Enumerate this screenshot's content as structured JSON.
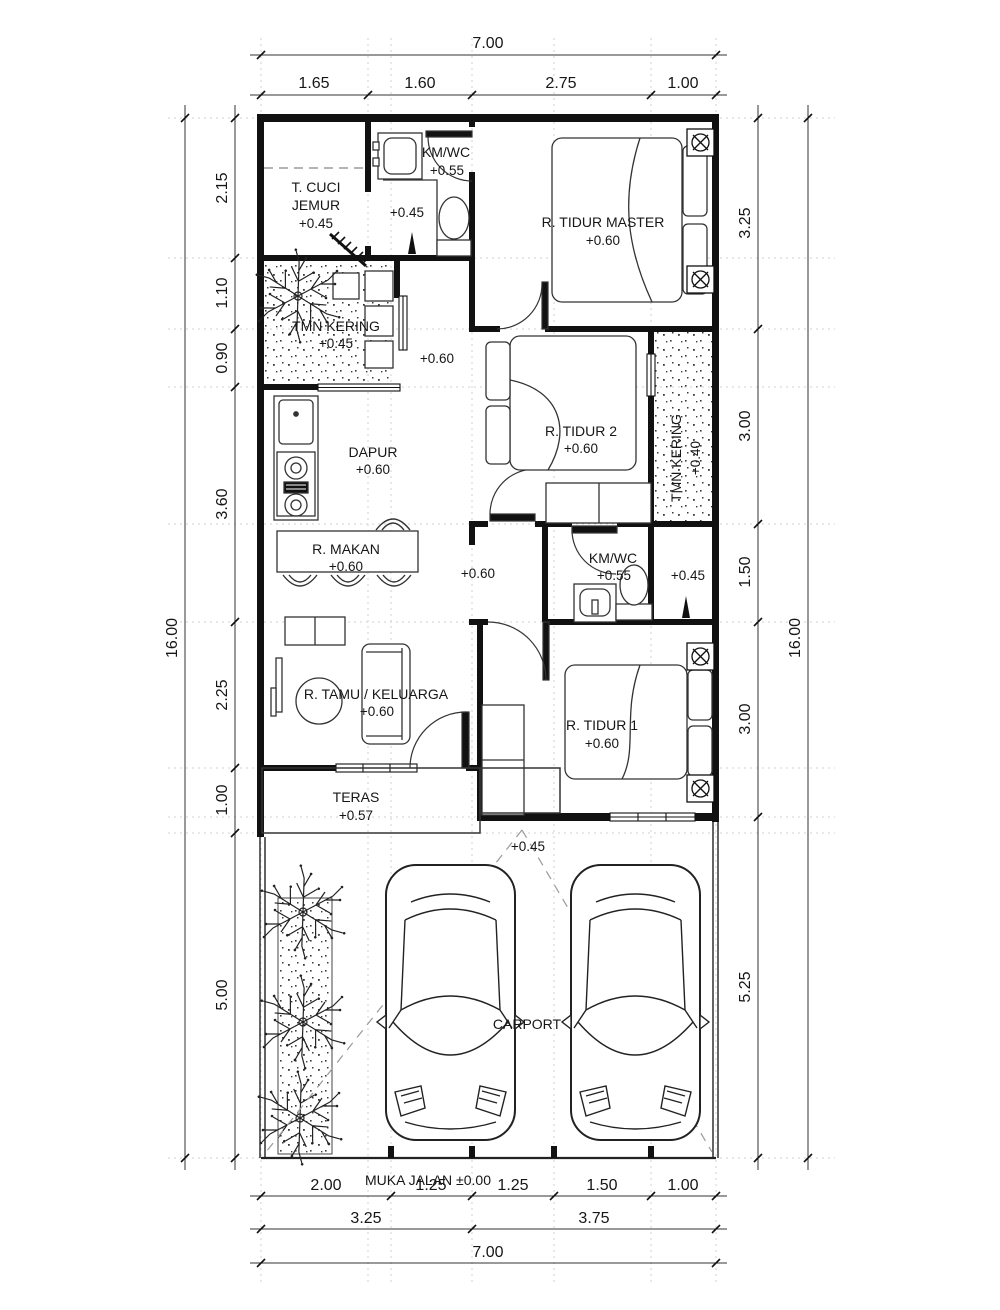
{
  "plan": {
    "road_label": "MUKA JALAN ±0.00",
    "rooms": {
      "t_cuci_jemur": {
        "line1": "T. CUCI",
        "line2": "JEMUR",
        "elev": "+0.45"
      },
      "km_wc_top": {
        "name": "KM/WC",
        "elev": "+0.55",
        "floor_elev": "+0.45"
      },
      "r_tidur_master": {
        "name": "R. TIDUR MASTER",
        "elev": "+0.60"
      },
      "tmn_kering_left": {
        "name": "TMN KERING",
        "elev": "+0.45"
      },
      "hall_top": {
        "elev": "+0.60"
      },
      "dapur": {
        "name": "DAPUR",
        "elev": "+0.60"
      },
      "r_tidur_2": {
        "name": "R. TIDUR 2",
        "elev": "+0.60"
      },
      "tmn_kering_right": {
        "name": "TMN KERING",
        "elev": "+0.40"
      },
      "r_makan": {
        "name": "R. MAKAN",
        "elev": "+0.60"
      },
      "hall_mid": {
        "elev": "+0.60"
      },
      "km_wc_mid": {
        "name": "KM/WC",
        "elev": "+0.55",
        "side_elev": "+0.45"
      },
      "r_tamu": {
        "name": "R. TAMU / KELUARGA",
        "elev": "+0.60"
      },
      "r_tidur_1": {
        "name": "R. TIDUR 1",
        "elev": "+0.60"
      },
      "teras": {
        "name": "TERAS",
        "elev": "+0.57"
      },
      "carport": {
        "name": "CARPORT",
        "entry_elev": "+0.45"
      }
    },
    "dims": {
      "top": {
        "total": "7.00",
        "segs": [
          "1.65",
          "1.60",
          "2.75",
          "1.00"
        ]
      },
      "bottom": {
        "total": "7.00",
        "subtotals": [
          "3.25",
          "3.75"
        ],
        "segs": [
          "2.00",
          "1.25",
          "1.25",
          "1.50",
          "1.00"
        ]
      },
      "left": {
        "total": "16.00",
        "segs": [
          "2.15",
          "1.10",
          "0.90",
          "3.60",
          "2.25",
          "1.00",
          "5.00"
        ]
      },
      "right": {
        "total": "16.00",
        "segs": [
          "3.25",
          "3.00",
          "1.50",
          "3.00",
          "5.25"
        ]
      }
    }
  }
}
